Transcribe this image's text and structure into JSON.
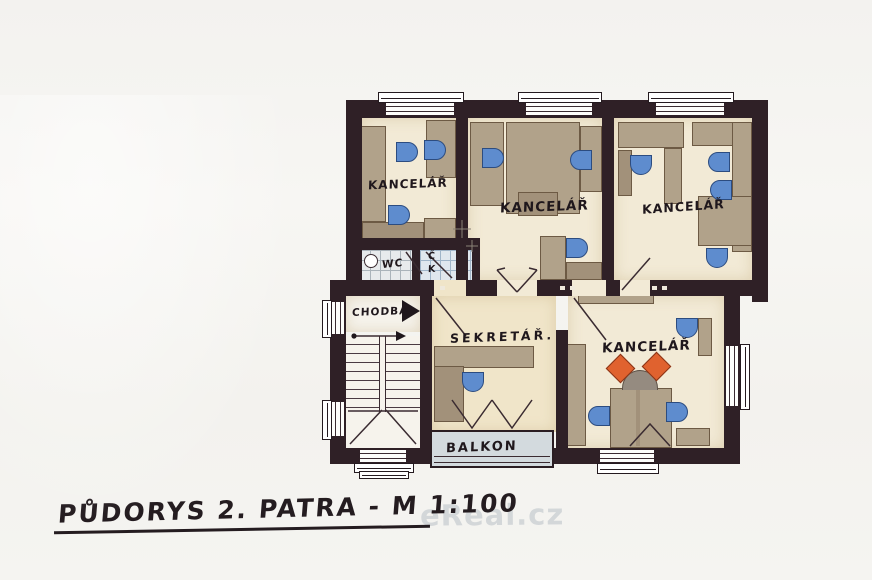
{
  "title": "PŮDORYS 2. PATRA - M 1:100",
  "watermark": "eReal.cz",
  "rooms": {
    "office1": {
      "label": "KANCELÁŘ"
    },
    "office2": {
      "label": "KANCELÁŘ"
    },
    "office3": {
      "label": "KANCELÁŘ"
    },
    "office4": {
      "label": "KANCELÁŘ"
    },
    "secretary": {
      "label": "SEKRETÁŘ."
    },
    "corridor": {
      "label": "CHODBA"
    },
    "wc": {
      "label": "WC"
    },
    "kitchenette": {
      "line1": "Č",
      "line2": "K"
    },
    "balcony": {
      "label": "BALKON"
    }
  },
  "colors": {
    "wall": "#2f2026",
    "floor_cream": "#f2ead6",
    "furniture_tan": "#b1a28a",
    "chair_blue": "#5e8cce",
    "chair_orange": "#e0622f",
    "balcony_grey": "#d3dade"
  }
}
